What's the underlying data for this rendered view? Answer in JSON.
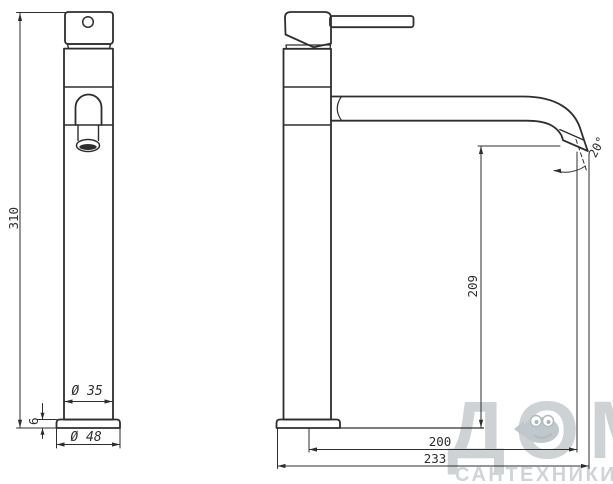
{
  "drawing": {
    "type": "technical-drawing",
    "subject": "tall single-lever basin mixer faucet, front and side orthographic views with dimensions",
    "views": [
      "front-view",
      "side-view"
    ],
    "colors": {
      "line": "#2e2e2e",
      "background": "#ffffff",
      "watermark": "#cdd2d4"
    },
    "dimensions": {
      "total_height": "310",
      "spout_height": "209",
      "spout_reach": "200",
      "max_depth": "233",
      "body_diameter": "Ø 35",
      "base_diameter": "Ø 48",
      "base_thickness": "6",
      "spout_angle": "20°"
    }
  },
  "watermark": {
    "title": "ДОМ",
    "subtitle": "САНТЕХНИКИ",
    "icon": "fish-mascot"
  }
}
